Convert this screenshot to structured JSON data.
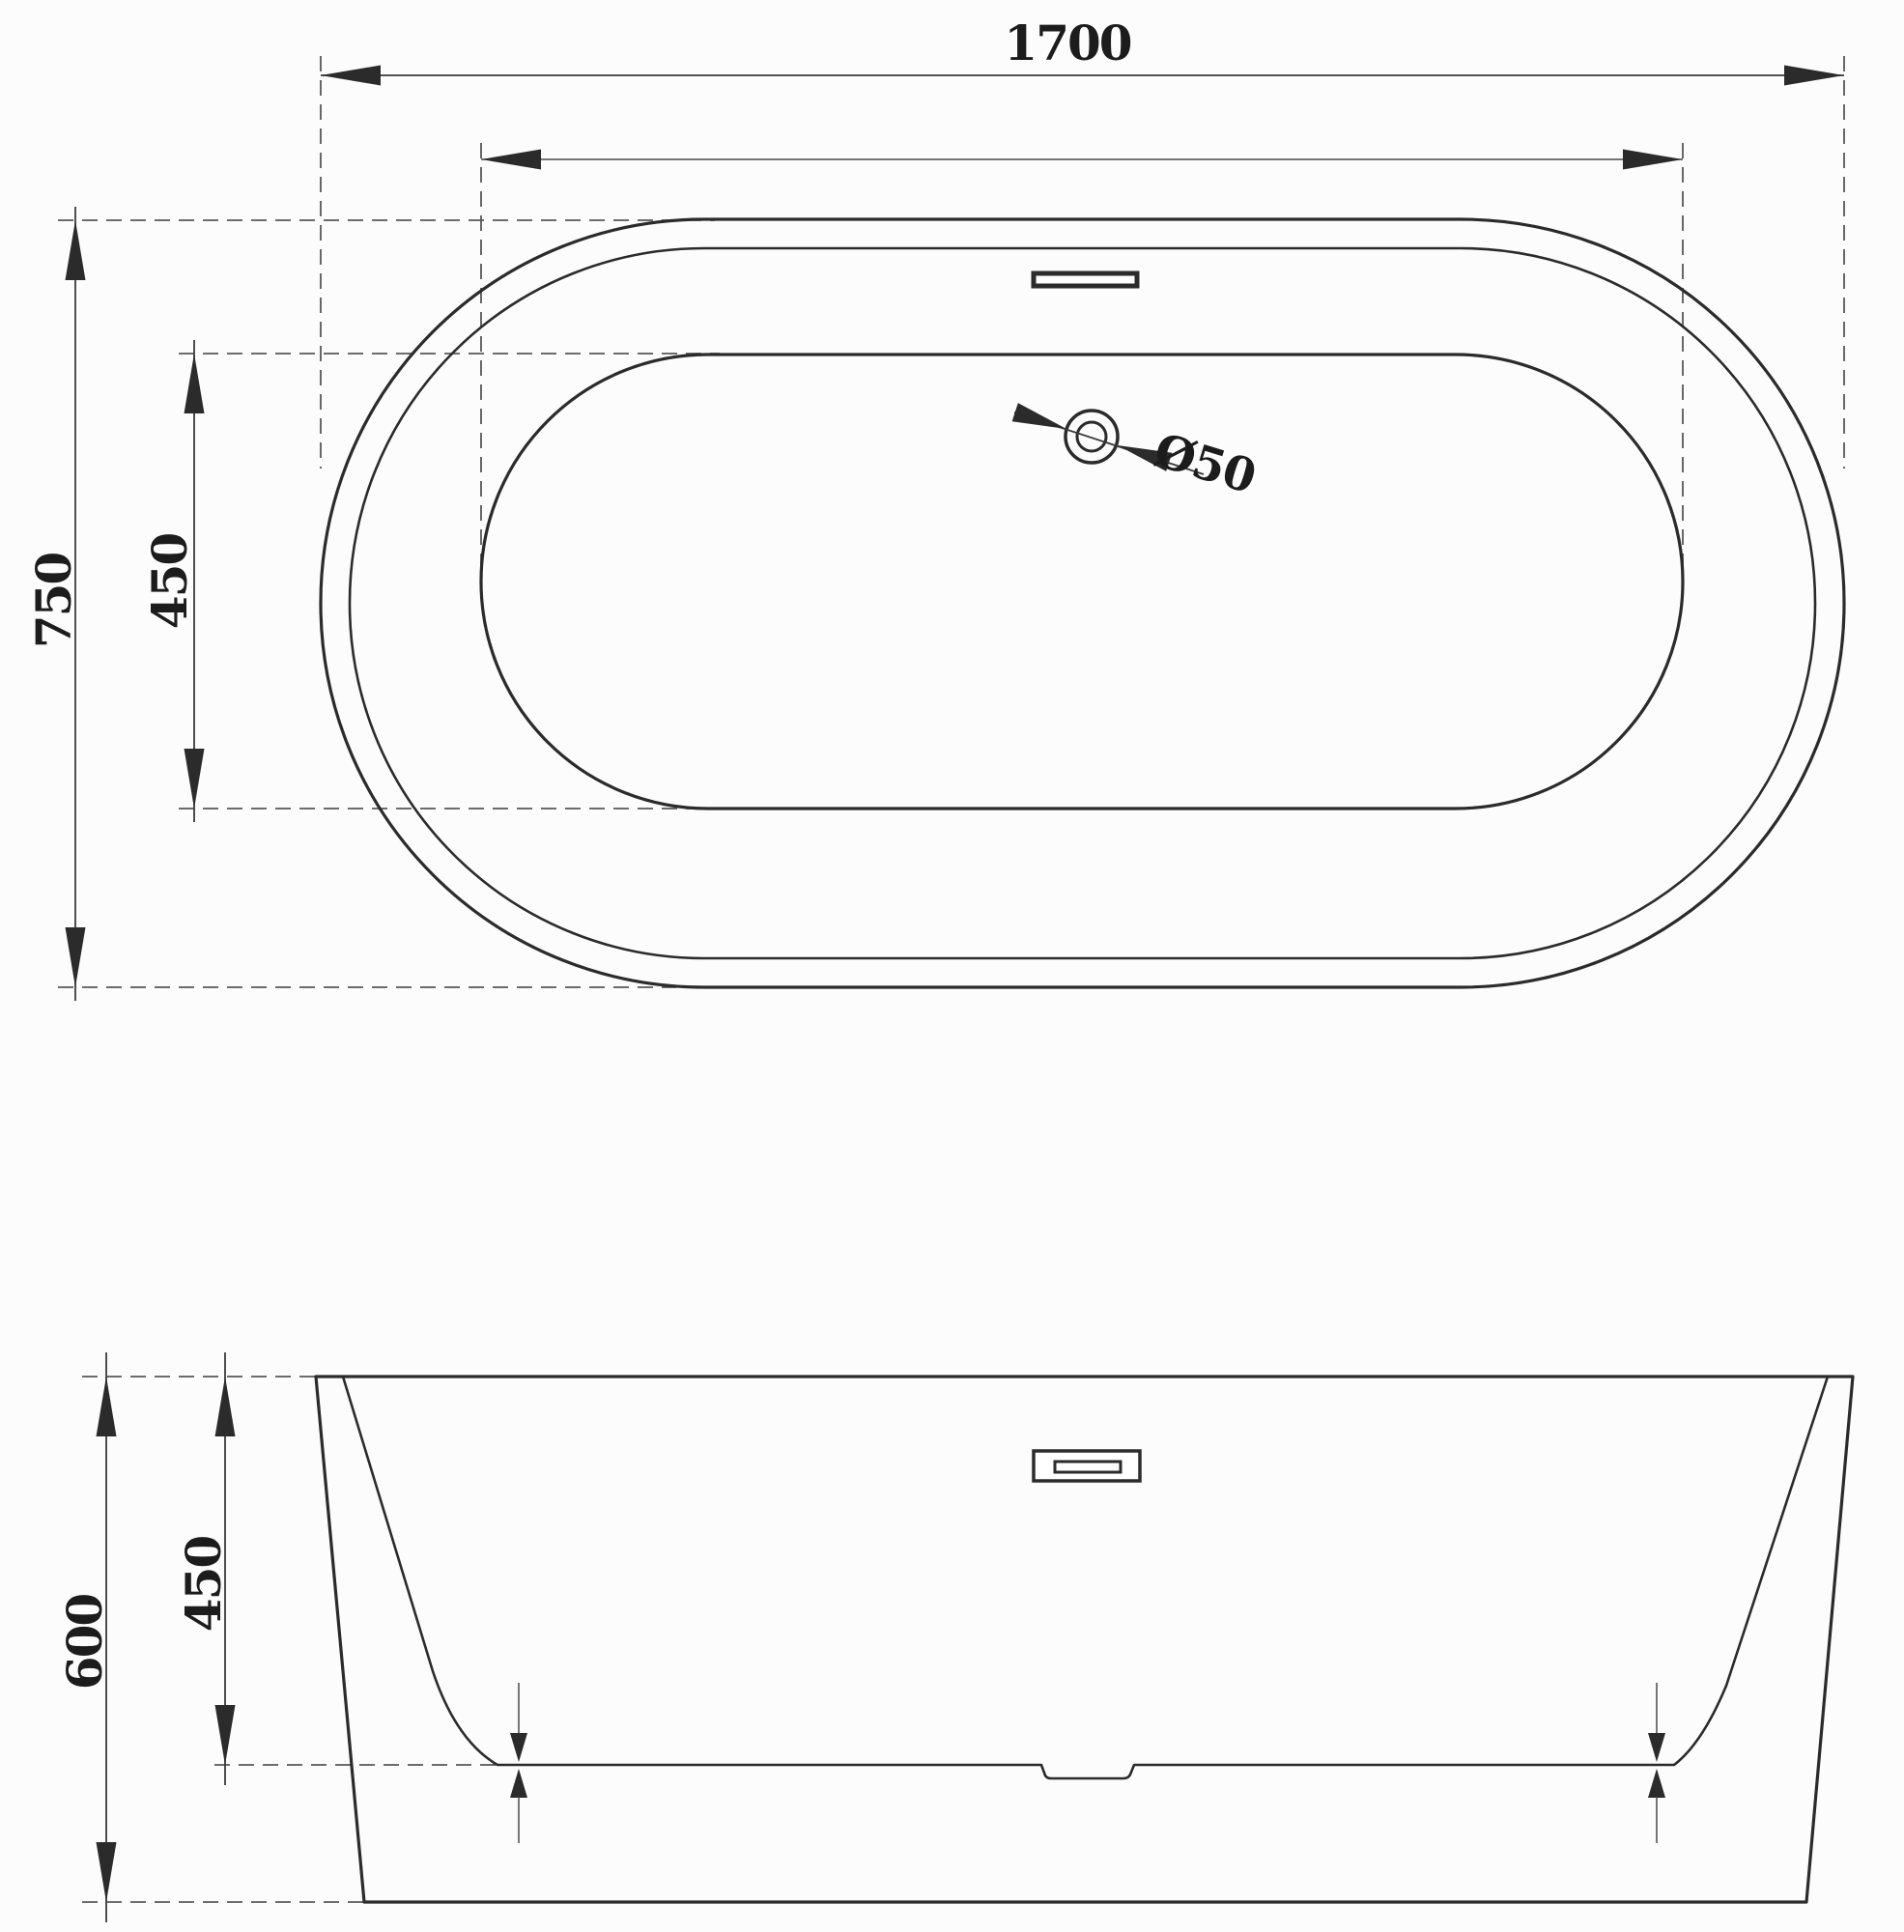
{
  "drawing": {
    "plan_view": {
      "overall_length_label": "1700",
      "overall_width_label": "750",
      "inner_width_label": "450",
      "drain_diameter_label": "Ø50"
    },
    "elevation_view": {
      "overall_height_label": "600",
      "inner_depth_label": "450"
    },
    "colors": {
      "line": "#2b2b2b",
      "dimension": "#3a3a3a",
      "background": "#fcfcfd"
    }
  }
}
